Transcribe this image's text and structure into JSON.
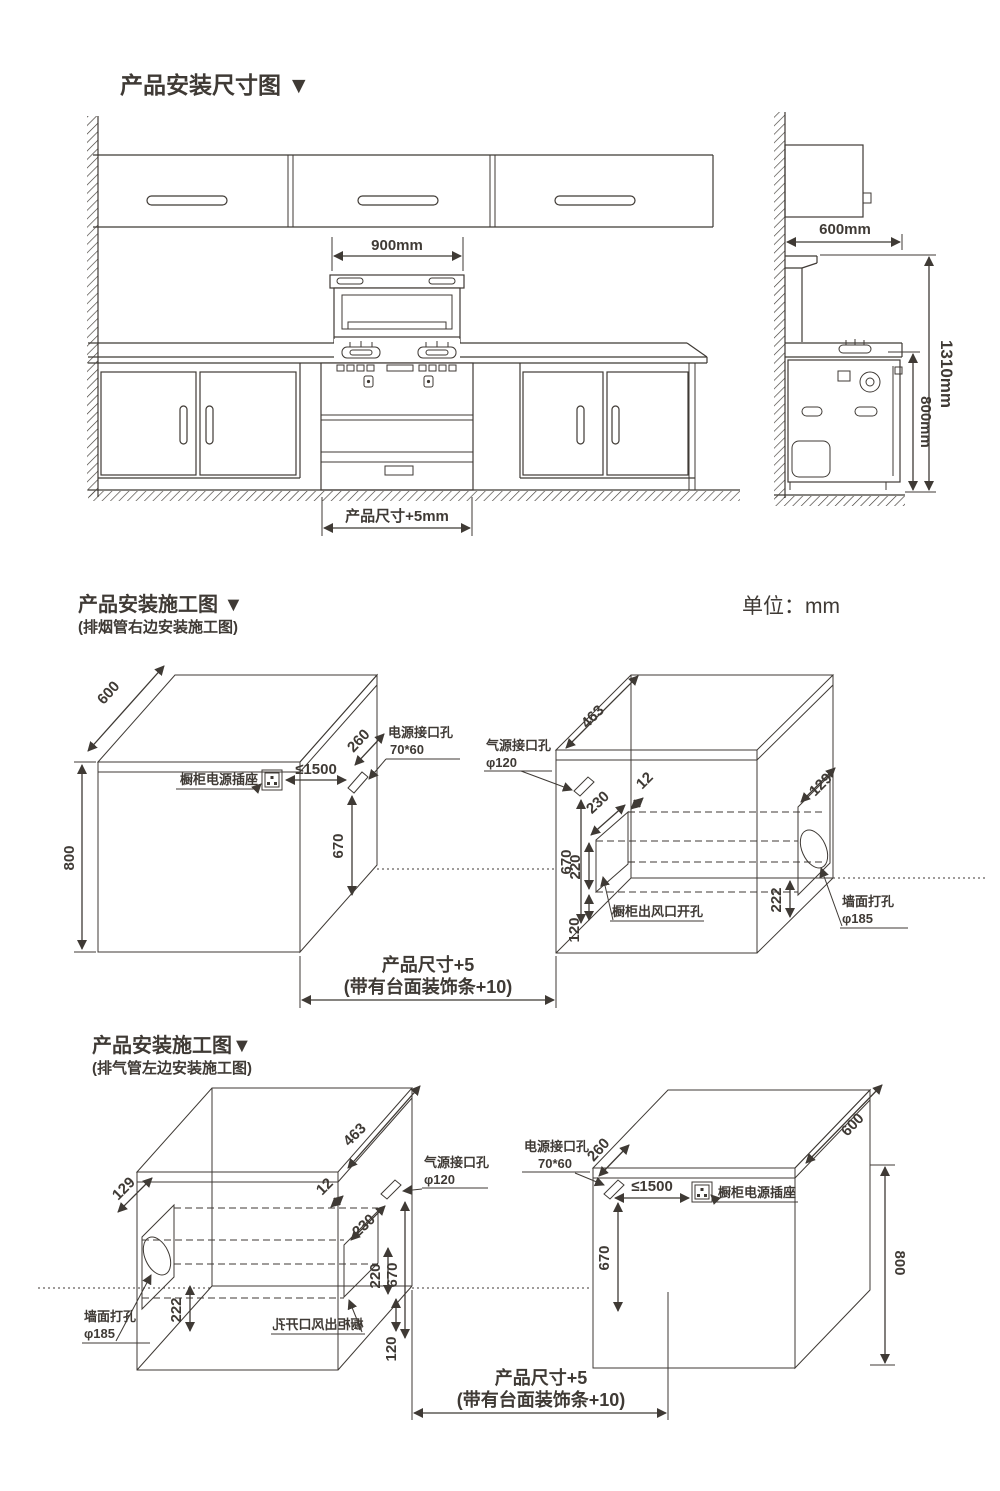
{
  "colors": {
    "ink": "#3f3a35",
    "bg": "#ffffff"
  },
  "s1": {
    "title": "产品安装尺寸图 ▼",
    "hood_width": "900mm",
    "product_width": "产品尺寸+5mm",
    "cabinet_depth": "600mm",
    "total_height": "1310mm",
    "counter_height": "800mm"
  },
  "s2": {
    "title": "产品安装施工图 ▼",
    "subtitle": "(排烟管右边安装施工图)",
    "unit": "单位：mm",
    "left_box": {
      "depth": "600",
      "height": "800",
      "socket_label": "橱柜电源插座",
      "socket_distance": "≤1500",
      "hole_offset": "260",
      "hole_label": "电源接口孔",
      "hole_size": "70*60",
      "hole_height": "670"
    },
    "right_box": {
      "gas_label": "气源接口孔",
      "gas_size": "φ120",
      "top_depth": "463",
      "inset": "12",
      "duct_width": "230",
      "gas_height": "670",
      "duct_height": "220",
      "duct_bottom": "120",
      "wall_inset": "129",
      "wall_bottom": "222",
      "wall_label": "墙面打孔",
      "wall_size": "φ185",
      "outlet_label": "橱柜出风口开孔"
    },
    "product_dim": "产品尺寸+5",
    "product_dim_note": "(带有台面装饰条+10)"
  },
  "s3": {
    "title": "产品安装施工图▼",
    "subtitle": "(排气管左边安装施工图)",
    "left_box": {
      "gas_label": "气源接口孔",
      "gas_size": "φ120",
      "top_depth": "463",
      "inset": "12",
      "duct_width": "230",
      "gas_height": "670",
      "duct_height": "220",
      "duct_bottom": "120",
      "wall_inset": "129",
      "wall_bottom": "222",
      "wall_label": "墙面打孔",
      "wall_size": "φ185",
      "outlet_label": "橱柜出风口开孔"
    },
    "right_box": {
      "depth": "600",
      "height": "800",
      "socket_label": "橱柜电源插座",
      "socket_distance": "≤1500",
      "hole_offset": "260",
      "hole_label": "电源接口孔",
      "hole_size": "70*60",
      "hole_height": "670"
    },
    "product_dim": "产品尺寸+5",
    "product_dim_note": "(带有台面装饰条+10)"
  }
}
